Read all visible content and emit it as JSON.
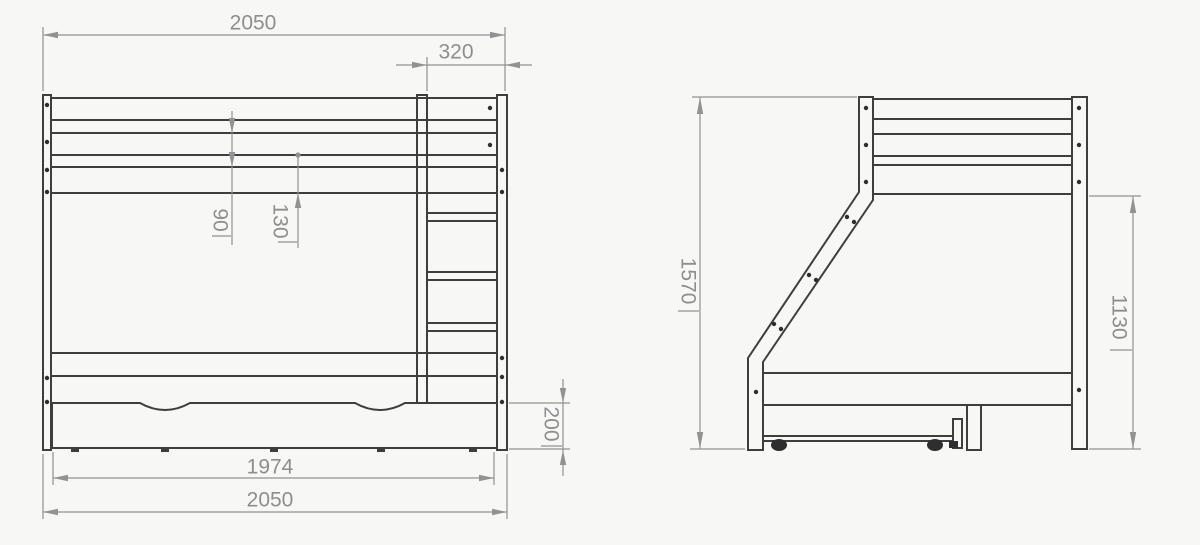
{
  "front_view": {
    "dimensions": {
      "total_width_top": "2050",
      "ladder_width": "320",
      "guard_rail_gap": "90",
      "rail_spacing": "130",
      "drawer_height": "200",
      "drawer_width": "1974",
      "total_width_bottom": "2050"
    }
  },
  "side_view": {
    "dimensions": {
      "total_height": "1570",
      "under_rail_height": "1130"
    }
  },
  "colors": {
    "line": "#3e3e3e",
    "dim_line": "#929292",
    "dim_text": "#8e8e8e",
    "background": "#f7f7f6",
    "dot": "#2e2e2e"
  }
}
